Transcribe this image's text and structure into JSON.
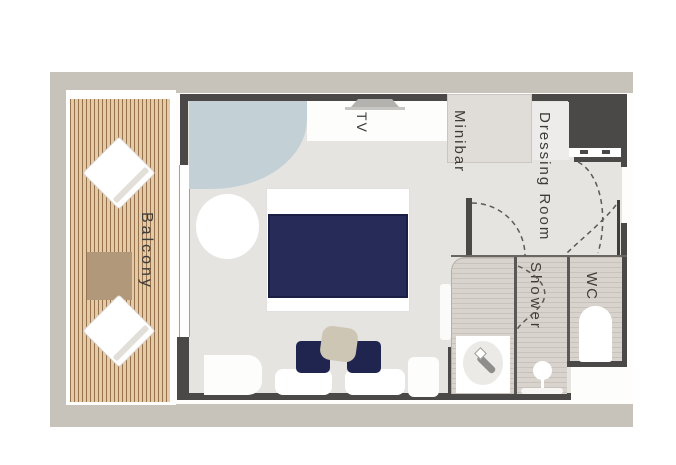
{
  "floorplan": {
    "labels": {
      "balcony": "Balcony",
      "tv": "TV",
      "minibar": "Minibar",
      "dressing_room": "Dressing Room",
      "shower": "Shower",
      "wc": "WC"
    },
    "colors": {
      "frame": "#c8c3ba",
      "wall": "#4a4947",
      "floor": "#e6e4e1",
      "balcony_wood": "#e4cba6",
      "balcony_wood_line": "#97724f",
      "balcony_table": "#b2987b",
      "bed_navy": "#262b58",
      "chair_navy": "#20254f",
      "accent_sofa_blue": "#c3d1d7",
      "coffee_table_tan": "#cec6b5",
      "tile_light": "#d9d3cd",
      "tile_dark": "#c9c2bc",
      "label_text": "#3e3c39"
    }
  }
}
